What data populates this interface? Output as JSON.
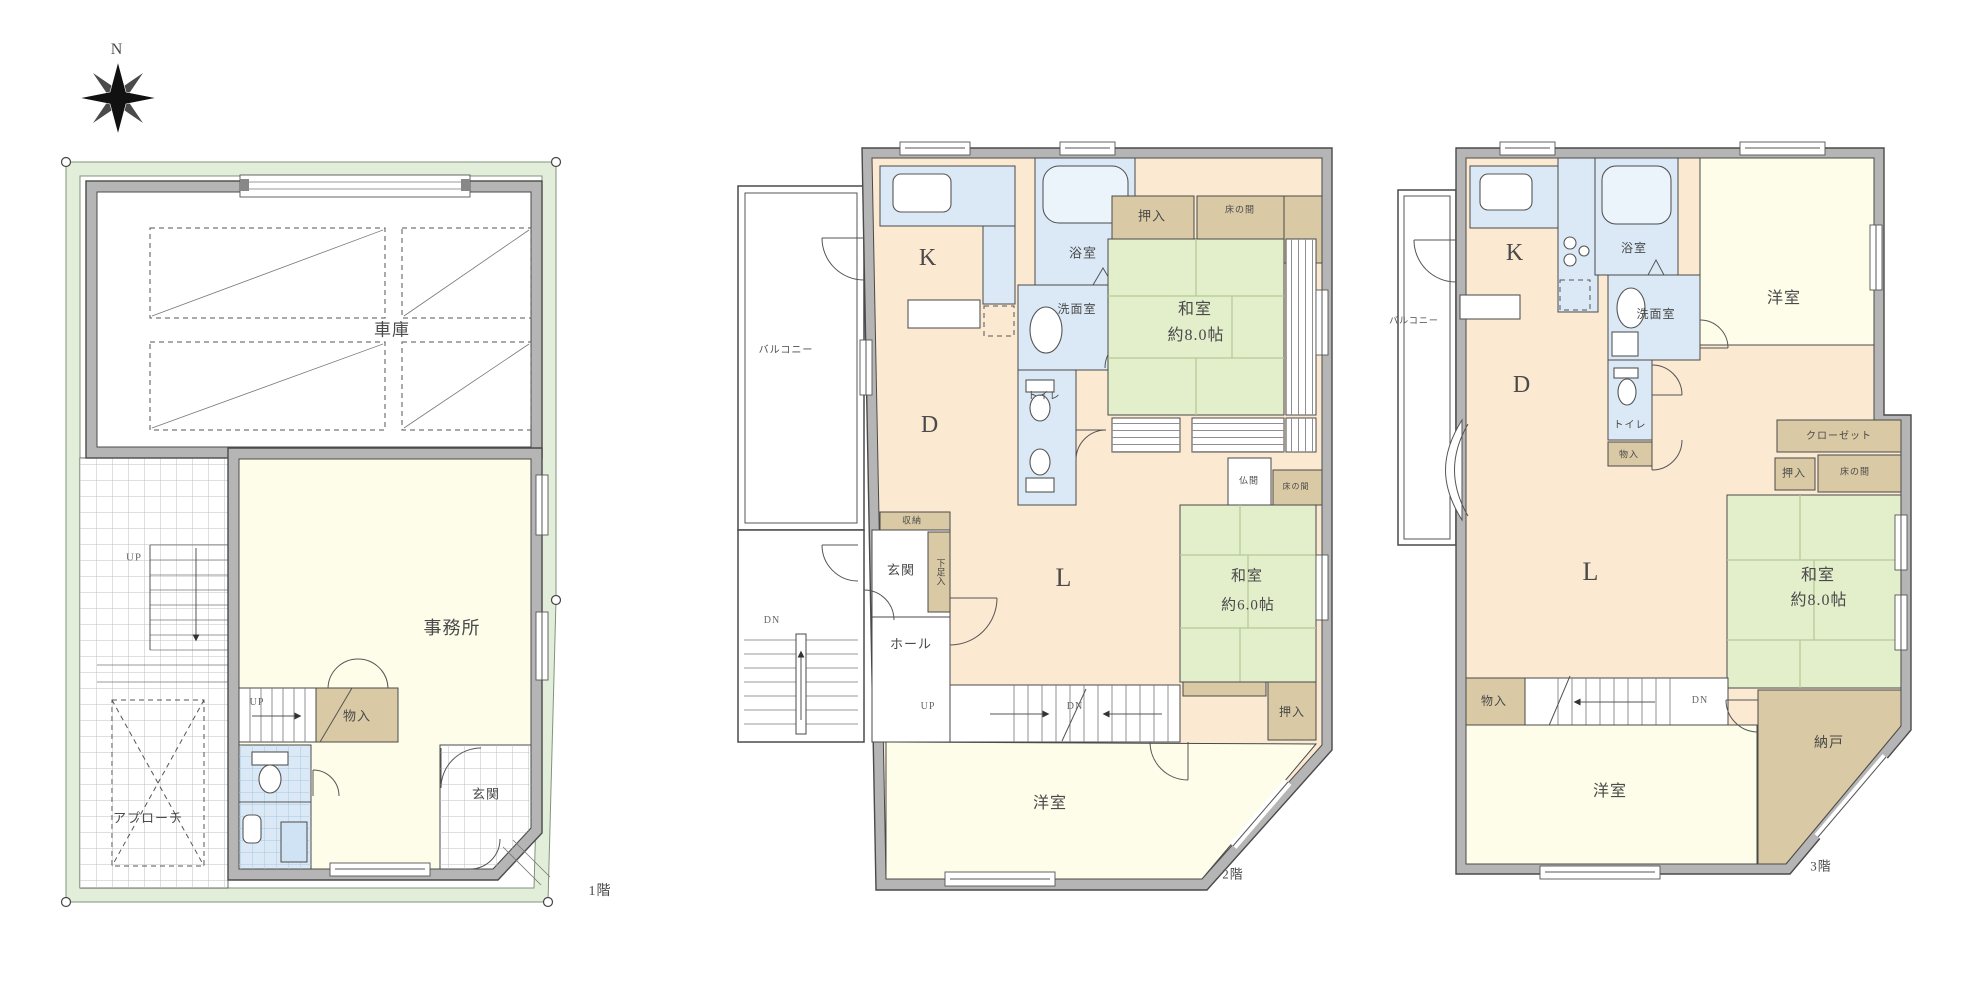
{
  "document_type": "floor-plan",
  "colors": {
    "site_green": "#e2eed9",
    "wall_gray": "#b5b5b5",
    "ldk_peach": "#fbe9d2",
    "room_cream": "#fdfdea",
    "tatami_green": "#e3eecb",
    "wet_blue": "#dbe9f6",
    "storage_tan": "#d9c9a4"
  },
  "labels": [
    {
      "id": "compass-n",
      "floor": "site",
      "text": "N",
      "x": 117,
      "y": 50,
      "size": 16
    },
    {
      "id": "f1-garage",
      "floor": "1F",
      "text": "車庫",
      "x": 392,
      "y": 330,
      "size": 17
    },
    {
      "id": "f1-office",
      "floor": "1F",
      "text": "事務所",
      "x": 452,
      "y": 628,
      "size": 18
    },
    {
      "id": "f1-up-outdoor",
      "floor": "1F",
      "text": "UP",
      "x": 134,
      "y": 558,
      "size": 11,
      "color": "#666"
    },
    {
      "id": "f1-up-indoor",
      "floor": "1F",
      "text": "UP",
      "x": 257,
      "y": 703,
      "size": 10,
      "color": "#666"
    },
    {
      "id": "f1-monoire",
      "floor": "1F",
      "text": "物入",
      "x": 357,
      "y": 716,
      "size": 13
    },
    {
      "id": "f1-approach",
      "floor": "1F",
      "text": "アプローチ",
      "x": 148,
      "y": 818,
      "size": 13
    },
    {
      "id": "f1-genkan",
      "floor": "1F",
      "text": "玄関",
      "x": 486,
      "y": 794,
      "size": 13
    },
    {
      "id": "f1-floor-label",
      "floor": "1F",
      "text": "1階",
      "x": 600,
      "y": 892,
      "size": 14
    },
    {
      "id": "f2-balcony",
      "floor": "2F",
      "text": "バルコニー",
      "x": 786,
      "y": 351,
      "size": 10
    },
    {
      "id": "f2-dn-outdoor",
      "floor": "2F",
      "text": "DN",
      "x": 772,
      "y": 621,
      "size": 10,
      "color": "#666"
    },
    {
      "id": "f2-kitchen",
      "floor": "2F",
      "text": "K",
      "x": 928,
      "y": 258,
      "size": 24
    },
    {
      "id": "f2-bath",
      "floor": "2F",
      "text": "浴室",
      "x": 1083,
      "y": 253,
      "size": 13
    },
    {
      "id": "f2-washroom",
      "floor": "2F",
      "text": "洗面室",
      "x": 1077,
      "y": 309,
      "size": 12
    },
    {
      "id": "f2-toilet",
      "floor": "2F",
      "text": "トイレ",
      "x": 1044,
      "y": 397,
      "size": 10
    },
    {
      "id": "f2-oshiire-top",
      "floor": "2F",
      "text": "押入",
      "x": 1152,
      "y": 216,
      "size": 13
    },
    {
      "id": "f2-tokonoma-top",
      "floor": "2F",
      "text": "床の間",
      "x": 1240,
      "y": 210,
      "size": 9
    },
    {
      "id": "f2-washitsu8",
      "floor": "2F",
      "text": "和室",
      "x": 1195,
      "y": 310,
      "size": 16
    },
    {
      "id": "f2-washitsu8-size",
      "floor": "2F",
      "text": "約8.0帖",
      "x": 1196,
      "y": 336,
      "size": 16
    },
    {
      "id": "f2-dining",
      "floor": "2F",
      "text": "D",
      "x": 930,
      "y": 425,
      "size": 24
    },
    {
      "id": "f2-shuno",
      "floor": "2F",
      "text": "収納",
      "x": 912,
      "y": 521,
      "size": 9
    },
    {
      "id": "f2-getabako",
      "floor": "2F",
      "text": "下足入",
      "x": 940,
      "y": 572,
      "size": 9,
      "vertical": true
    },
    {
      "id": "f2-genkan",
      "floor": "2F",
      "text": "玄関",
      "x": 901,
      "y": 570,
      "size": 13
    },
    {
      "id": "f2-hall",
      "floor": "2F",
      "text": "ホール",
      "x": 911,
      "y": 644,
      "size": 13
    },
    {
      "id": "f2-up",
      "floor": "2F",
      "text": "UP",
      "x": 928,
      "y": 707,
      "size": 10,
      "color": "#666"
    },
    {
      "id": "f2-dn",
      "floor": "2F",
      "text": "DN",
      "x": 1075,
      "y": 707,
      "size": 10,
      "color": "#666"
    },
    {
      "id": "f2-living",
      "floor": "2F",
      "text": "L",
      "x": 1064,
      "y": 578,
      "size": 26
    },
    {
      "id": "f2-butsuma",
      "floor": "2F",
      "text": "仏間",
      "x": 1249,
      "y": 481,
      "size": 9
    },
    {
      "id": "f2-tokonoma-mid",
      "floor": "2F",
      "text": "床の間",
      "x": 1296,
      "y": 487,
      "size": 8
    },
    {
      "id": "f2-washitsu6",
      "floor": "2F",
      "text": "和室",
      "x": 1247,
      "y": 577,
      "size": 15
    },
    {
      "id": "f2-washitsu6-size",
      "floor": "2F",
      "text": "約6.0帖",
      "x": 1248,
      "y": 606,
      "size": 15
    },
    {
      "id": "f2-oshiire-btm",
      "floor": "2F",
      "text": "押入",
      "x": 1292,
      "y": 712,
      "size": 12
    },
    {
      "id": "f2-yoshitsu",
      "floor": "2F",
      "text": "洋室",
      "x": 1050,
      "y": 804,
      "size": 16
    },
    {
      "id": "f2-floor-label",
      "floor": "2F",
      "text": "2階",
      "x": 1233,
      "y": 874,
      "size": 13
    },
    {
      "id": "f3-balcony",
      "floor": "3F",
      "text": "バルコニー",
      "x": 1414,
      "y": 321,
      "size": 9
    },
    {
      "id": "f3-kitchen",
      "floor": "3F",
      "text": "K",
      "x": 1515,
      "y": 253,
      "size": 24
    },
    {
      "id": "f3-bath",
      "floor": "3F",
      "text": "浴室",
      "x": 1634,
      "y": 248,
      "size": 12
    },
    {
      "id": "f3-washroom",
      "floor": "3F",
      "text": "洗面室",
      "x": 1656,
      "y": 314,
      "size": 12
    },
    {
      "id": "f3-yoshitsu-top",
      "floor": "3F",
      "text": "洋室",
      "x": 1784,
      "y": 299,
      "size": 16
    },
    {
      "id": "f3-dining",
      "floor": "3F",
      "text": "D",
      "x": 1522,
      "y": 385,
      "size": 24
    },
    {
      "id": "f3-toilet",
      "floor": "3F",
      "text": "トイレ",
      "x": 1630,
      "y": 426,
      "size": 10
    },
    {
      "id": "f3-monoire-small",
      "floor": "3F",
      "text": "物入",
      "x": 1629,
      "y": 455,
      "size": 9
    },
    {
      "id": "f3-closet",
      "floor": "3F",
      "text": "クローゼット",
      "x": 1839,
      "y": 437,
      "size": 10
    },
    {
      "id": "f3-oshiire",
      "floor": "3F",
      "text": "押入",
      "x": 1794,
      "y": 474,
      "size": 11
    },
    {
      "id": "f3-tokonoma",
      "floor": "3F",
      "text": "床の間",
      "x": 1855,
      "y": 472,
      "size": 9
    },
    {
      "id": "f3-washitsu8",
      "floor": "3F",
      "text": "和室",
      "x": 1818,
      "y": 576,
      "size": 16
    },
    {
      "id": "f3-washitsu8-size",
      "floor": "3F",
      "text": "約8.0帖",
      "x": 1819,
      "y": 601,
      "size": 16
    },
    {
      "id": "f3-living",
      "floor": "3F",
      "text": "L",
      "x": 1591,
      "y": 572,
      "size": 26
    },
    {
      "id": "f3-monoire",
      "floor": "3F",
      "text": "物入",
      "x": 1494,
      "y": 701,
      "size": 12
    },
    {
      "id": "f3-dn",
      "floor": "3F",
      "text": "DN",
      "x": 1700,
      "y": 701,
      "size": 10,
      "color": "#666"
    },
    {
      "id": "f3-yoshitsu-btm",
      "floor": "3F",
      "text": "洋室",
      "x": 1610,
      "y": 792,
      "size": 16
    },
    {
      "id": "f3-nando",
      "floor": "3F",
      "text": "納戸",
      "x": 1829,
      "y": 744,
      "size": 14
    },
    {
      "id": "f3-floor-label",
      "floor": "3F",
      "text": "3階",
      "x": 1821,
      "y": 866,
      "size": 13
    }
  ]
}
